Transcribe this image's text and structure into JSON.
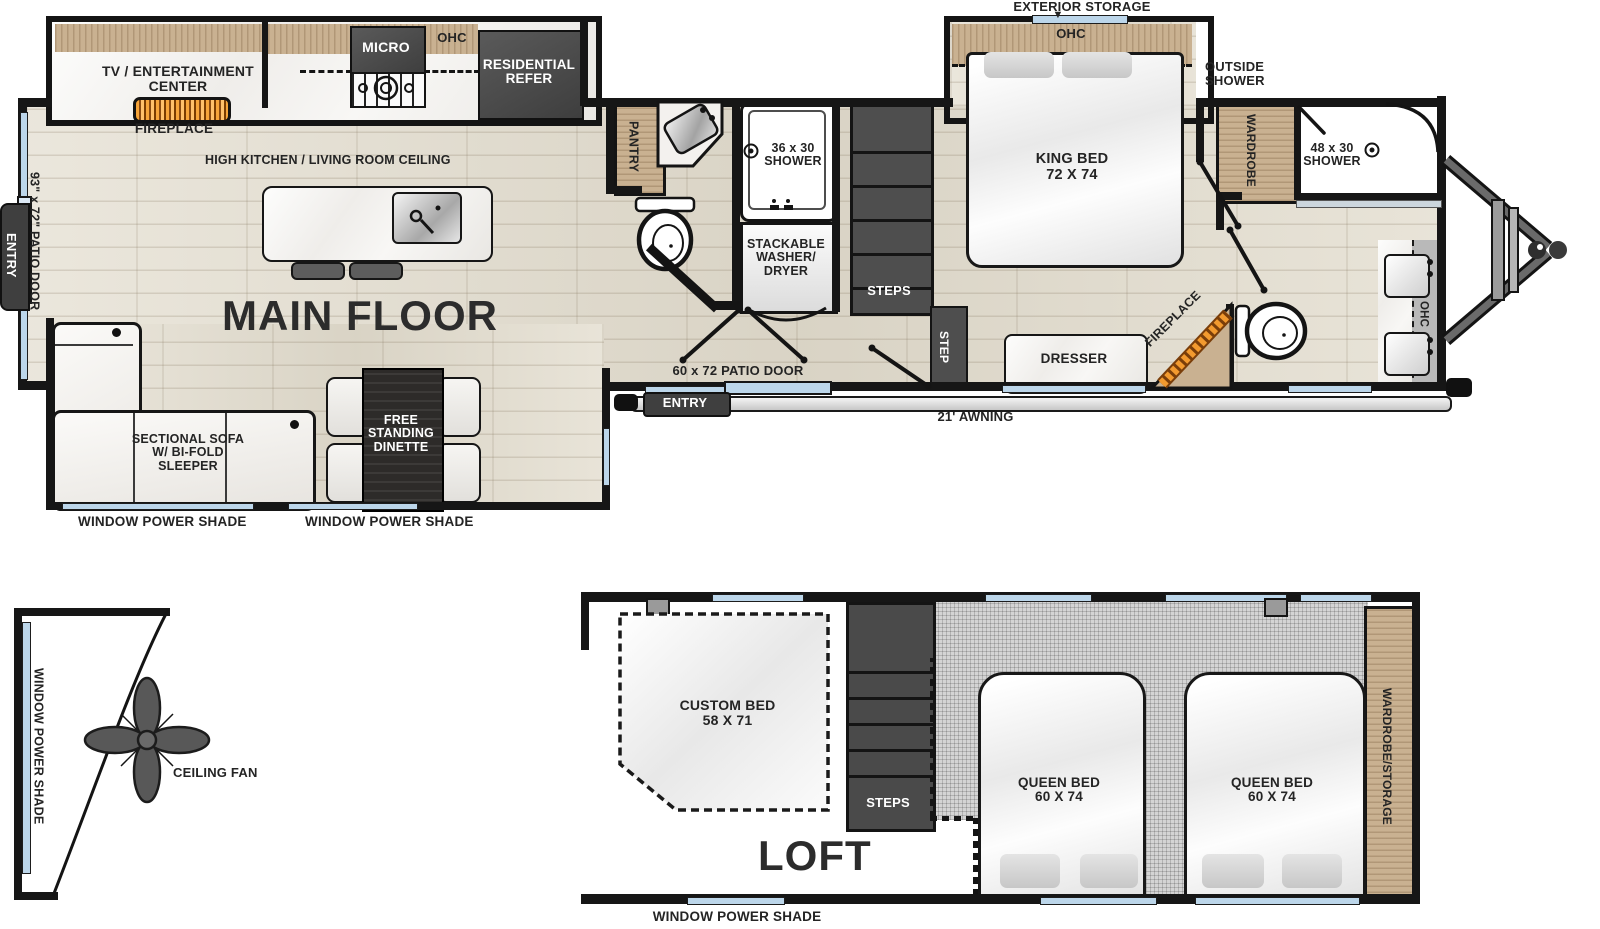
{
  "colors": {
    "wall": "#161616",
    "window_glass": "#bcd6ea",
    "cabinet_wood": "#c9b191",
    "appliance_dark": "#4a4a4a",
    "floor_wood": "#e2dccd",
    "carpet": "#d4d4d4",
    "flame": "#f29a2f"
  },
  "mf": {
    "title": "MAIN FLOOR",
    "tv_center": "TV / ENTERTAINMENT\nCENTER",
    "fireplace_living": "FIREPLACE",
    "micro": "MICRO",
    "ohc_kitchen": "OHC",
    "refer": "RESIDENTIAL\nREFER",
    "high_ceiling": "HIGH KITCHEN / LIVING ROOM CEILING",
    "entry_side": "ENTRY",
    "patio_door_side": "93\" x 72\" PATIO DOOR",
    "sofa": "SECTIONAL SOFA\nW/ BI-FOLD\nSLEEPER",
    "dinette": "FREE\nSTANDING\nDINETTE",
    "shade_left": "WINDOW POWER SHADE",
    "shade_right": "WINDOW POWER SHADE",
    "pantry": "PANTRY",
    "shower_mid": "36 x 30\nSHOWER",
    "washer_dryer": "STACKABLE\nWASHER/\nDRYER",
    "steps": "STEPS",
    "step": "STEP",
    "patio_door_rear": "60 x 72 PATIO DOOR",
    "entry_rear": "ENTRY",
    "awning": "21' AWNING",
    "exterior_storage": "EXTERIOR STORAGE",
    "arrow_down": "▼",
    "ohc_bedroom": "OHC",
    "king_bed": "KING BED\n72 X 74",
    "outside_shower": "OUTSIDE\nSHOWER",
    "wardrobe": "WARDROBE",
    "shower_front": "48 x 30\nSHOWER",
    "dresser": "DRESSER",
    "fireplace_front": "FIREPLACE",
    "ohc_vanity": "OHC"
  },
  "cap": {
    "shade": "WINDOW POWER SHADE",
    "fan": "CEILING FAN"
  },
  "loft": {
    "title": "LOFT",
    "custom_bed": "CUSTOM BED\n58 X 71",
    "steps": "STEPS",
    "queen_bed_left": "QUEEN BED\n60 X 74",
    "queen_bed_right": "QUEEN BED\n60 X 74",
    "wardrobe_storage": "WARDROBE/STORAGE",
    "shade": "WINDOW POWER SHADE"
  }
}
